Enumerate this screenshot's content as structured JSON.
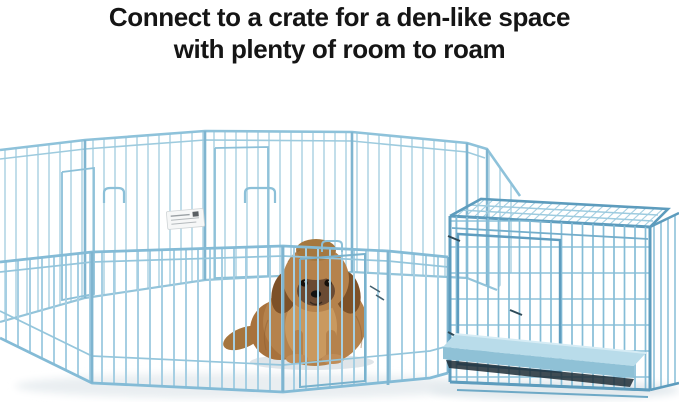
{
  "headline": {
    "line1": "Connect to a crate for a den-like space",
    "line2": "with plenty of room to roam"
  },
  "scene": {
    "alt": "A tan Shih Tzu puppy sits inside a light blue wire exercise pen that connects to a matching blue folding wire dog crate with a blue plastic floor pan",
    "elements": {
      "playpen": "octagonal blue wire exercise pen",
      "crate": "blue wire dog crate with plastic pan",
      "dog": "tan Shih Tzu puppy",
      "tag": "white product tag hanging on pen panel"
    },
    "colors": {
      "background": "#ffffff",
      "headline_text": "#151515",
      "pen_wire": "#aed2e3",
      "pen_wire_front": "#a6cfe3",
      "pen_rail": "#84bbd6",
      "crate_wire": "#85bdd7",
      "crate_rail": "#5d9cbd",
      "tray_top": "#b9dcea",
      "tray_front": "#8fc1d6",
      "tray_shadow": "#1d2d36",
      "dog_coat": "#b5824c",
      "dog_chest": "#c9995f",
      "dog_ear": "#7d5128",
      "dog_face": "#6a4a33",
      "shadow": "#dfe5e9"
    }
  }
}
